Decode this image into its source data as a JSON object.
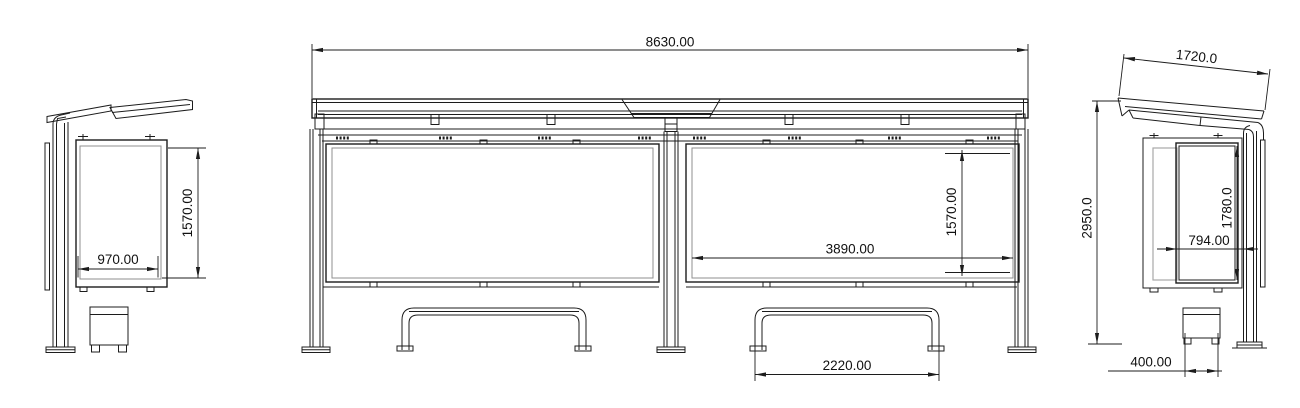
{
  "drawing": {
    "kind": "shelter-orthographic-views",
    "colors": {
      "background": "#ffffff",
      "line": "#1c1c1c",
      "secondary_line": "#8f8f8f"
    },
    "views": {
      "left_side": {
        "name": "left-side-view",
        "dims": {
          "panel_width": {
            "label": "970.00"
          },
          "panel_height": {
            "label": "1570.00"
          }
        }
      },
      "front": {
        "name": "front-elevation-view",
        "dims": {
          "overall_width": {
            "label": "8630.00"
          },
          "glass_width": {
            "label": "3890.00"
          },
          "glass_height": {
            "label": "1570.00"
          },
          "bench_width": {
            "label": "2220.00"
          }
        }
      },
      "right_side": {
        "name": "right-side-view",
        "dims": {
          "roof_depth": {
            "label": "1720.0"
          },
          "overall_height": {
            "label": "2950.0"
          },
          "panel_height": {
            "label": "1780.0"
          },
          "panel_width": {
            "label": "794.00"
          },
          "bench_depth": {
            "label": "400.00"
          }
        }
      }
    }
  }
}
